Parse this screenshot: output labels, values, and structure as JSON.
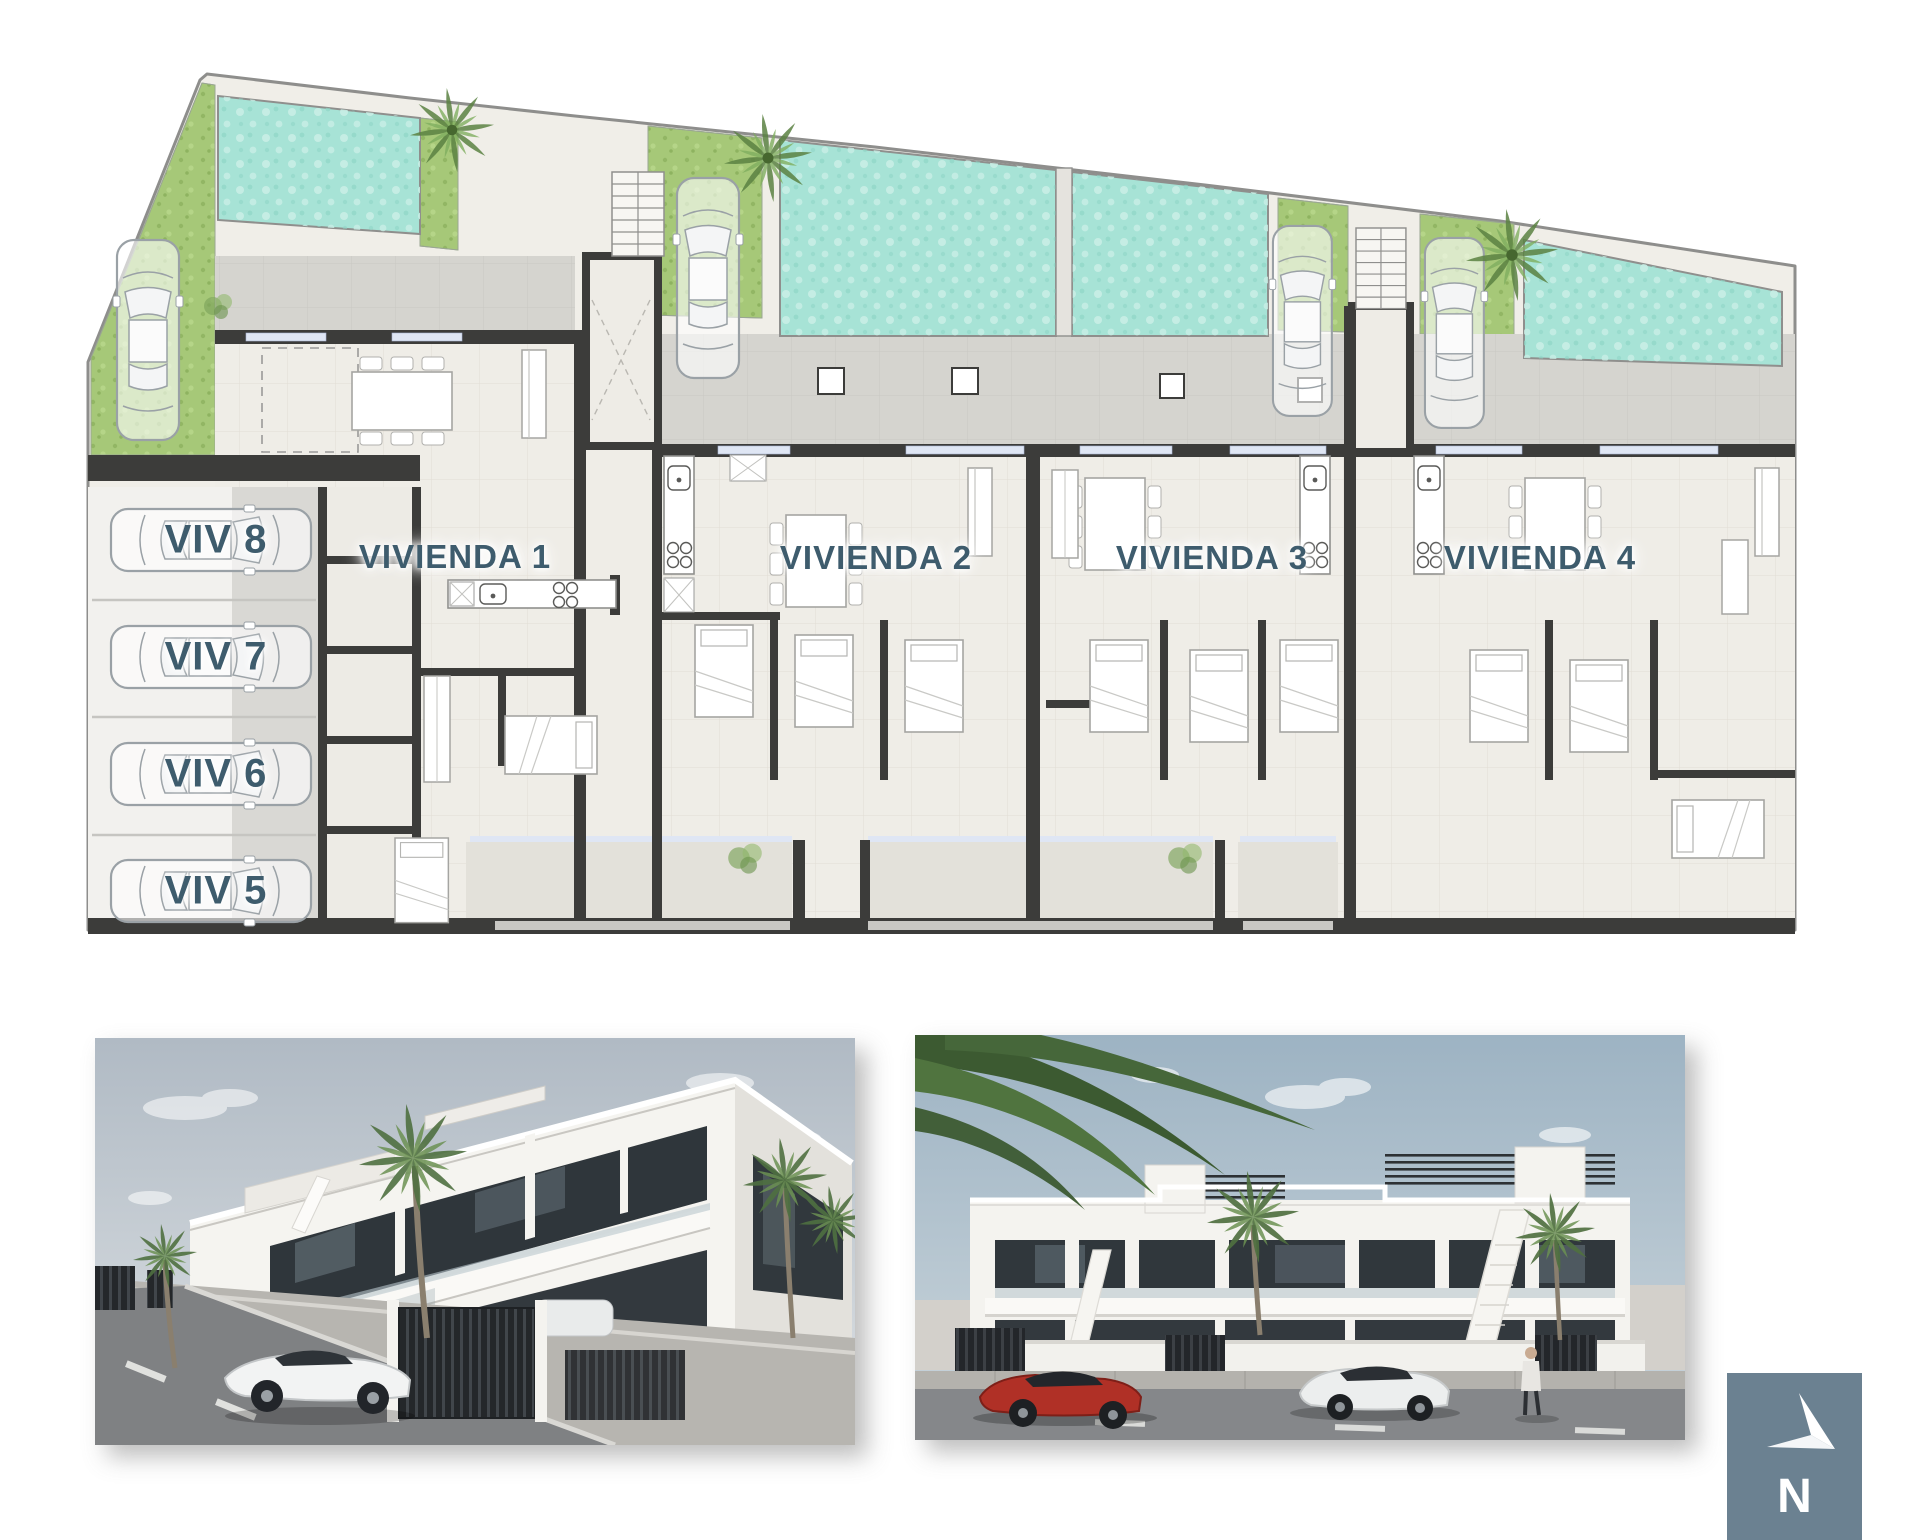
{
  "plan": {
    "units": [
      {
        "id": "vivienda-1",
        "label": "VIVIENDA 1"
      },
      {
        "id": "vivienda-2",
        "label": "VIVIENDA 2"
      },
      {
        "id": "vivienda-3",
        "label": "VIVIENDA 3"
      },
      {
        "id": "vivienda-4",
        "label": "VIVIENDA 4"
      }
    ],
    "parking": [
      {
        "id": "viv-8",
        "label": "VIV 8"
      },
      {
        "id": "viv-7",
        "label": "VIV 7"
      },
      {
        "id": "viv-6",
        "label": "VIV 6"
      },
      {
        "id": "viv-5",
        "label": "VIV 5"
      }
    ],
    "colors": {
      "pool": "#a7e3d6",
      "grass": "#a6c878",
      "terrace": "#d5d4cf",
      "floor": "#efede7",
      "wall_dark": "#3c3c3a",
      "outline": "#8e8e8c",
      "glazing": "#dfe6f4",
      "label_text": "#3e5c6d"
    }
  },
  "compass": {
    "label": "N",
    "background": "#6b8191"
  }
}
